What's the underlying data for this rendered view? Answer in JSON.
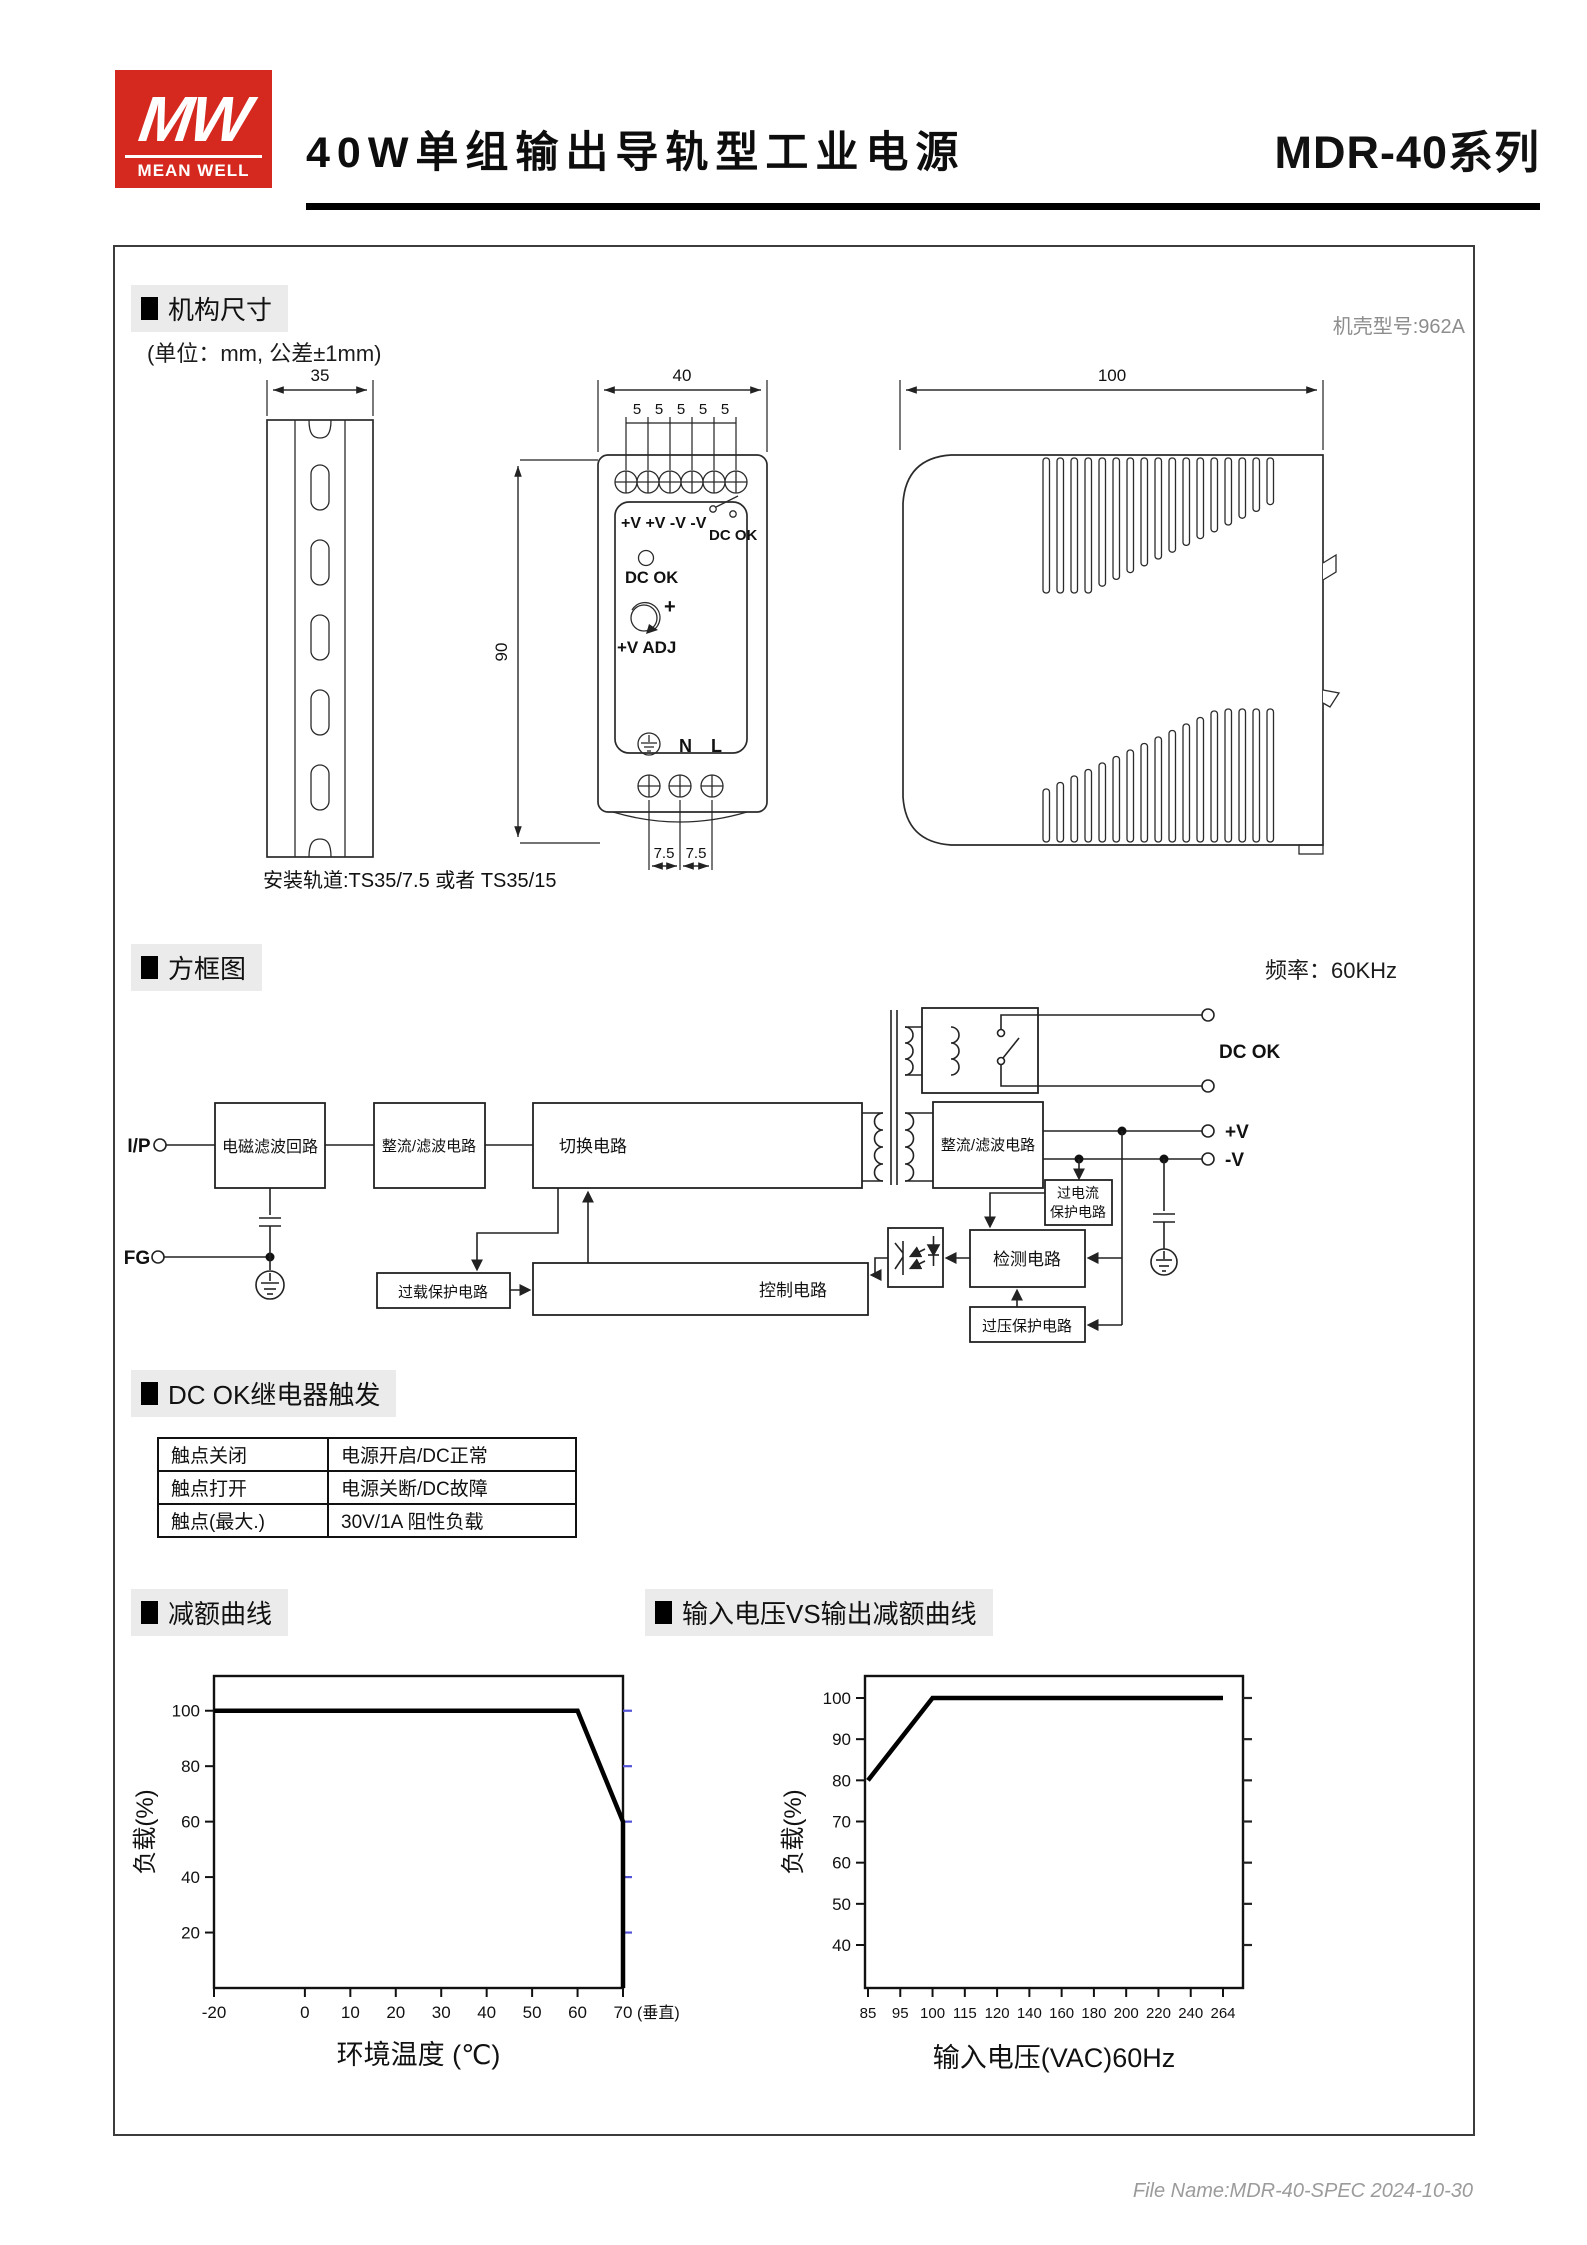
{
  "header": {
    "logo_top": "MW",
    "logo_bottom": "MEAN WELL",
    "title": "40W单组输出导轨型工业电源",
    "series": "MDR-40系列"
  },
  "mech": {
    "section_title": "机构尺寸",
    "unit_note": "(单位：mm, 公差±1mm)",
    "case_note": "机壳型号:962A",
    "rail_note": "安装轨道:TS35/7.5 或者 TS35/15",
    "dims": {
      "rail_width": "35",
      "unit_width": "40",
      "unit_height": "90",
      "pitch": "5",
      "pitch_bottom": "7.5",
      "depth": "100"
    },
    "panel": {
      "terminals_top": "+V +V -V -V",
      "relay_label": "DC OK",
      "led_label": "DC OK",
      "adj_plus": "+",
      "adj_label": "+V ADJ",
      "n": "N",
      "l": "L"
    }
  },
  "block": {
    "section_title": "方框图",
    "freq_note": "频率：60KHz",
    "terminals": {
      "input": "I/P",
      "fg": "FG",
      "dcok": "DC OK",
      "vplus": "+V",
      "vminus": "-V"
    },
    "boxes": {
      "emi": "电磁滤波回路",
      "rectifier1": "整流/滤波电路",
      "switching": "切换电路",
      "rectifier2": "整流/滤波电路",
      "ocp_line1": "过电流",
      "ocp_line2": "保护电路",
      "detection": "检测电路",
      "ovp": "过压保护电路",
      "control": "控制电路",
      "overload": "过载保护电路"
    }
  },
  "relay": {
    "section_title": "DC OK继电器触发",
    "rows": [
      {
        "label": "触点关闭",
        "value": "电源开启/DC正常"
      },
      {
        "label": "触点打开",
        "value": "电源关断/DC故障"
      },
      {
        "label": "触点(最大.)",
        "value": "30V/1A 阻性负载"
      }
    ]
  },
  "footer": {
    "file_info": "File Name:MDR-40-SPEC  2024-10-30"
  },
  "chart_data": [
    {
      "type": "line",
      "title": "减额曲线",
      "xlabel": "环境温度 (℃)",
      "ylabel": "负载(%)",
      "x_ticks": [
        -20,
        0,
        10,
        20,
        30,
        40,
        50,
        60,
        70
      ],
      "x_suffix": "(垂直)",
      "y_ticks": [
        20,
        40,
        60,
        80,
        100
      ],
      "xlim": [
        -20,
        70
      ],
      "ylim": [
        0,
        110
      ],
      "grid": false,
      "points": [
        [
          -20,
          100
        ],
        [
          60,
          100
        ],
        [
          70,
          60
        ],
        [
          70,
          0
        ]
      ]
    },
    {
      "type": "line",
      "title": "输入电压VS输出减额曲线",
      "xlabel": "输入电压(VAC)60Hz",
      "ylabel": "负载(%)",
      "x_ticks": [
        85,
        95,
        100,
        115,
        120,
        140,
        160,
        180,
        200,
        220,
        240,
        264
      ],
      "y_ticks": [
        40,
        50,
        60,
        70,
        80,
        90,
        100
      ],
      "x_scale": "ordinal",
      "grid": false,
      "points": [
        [
          85,
          80
        ],
        [
          100,
          100
        ],
        [
          264,
          100
        ]
      ]
    }
  ]
}
